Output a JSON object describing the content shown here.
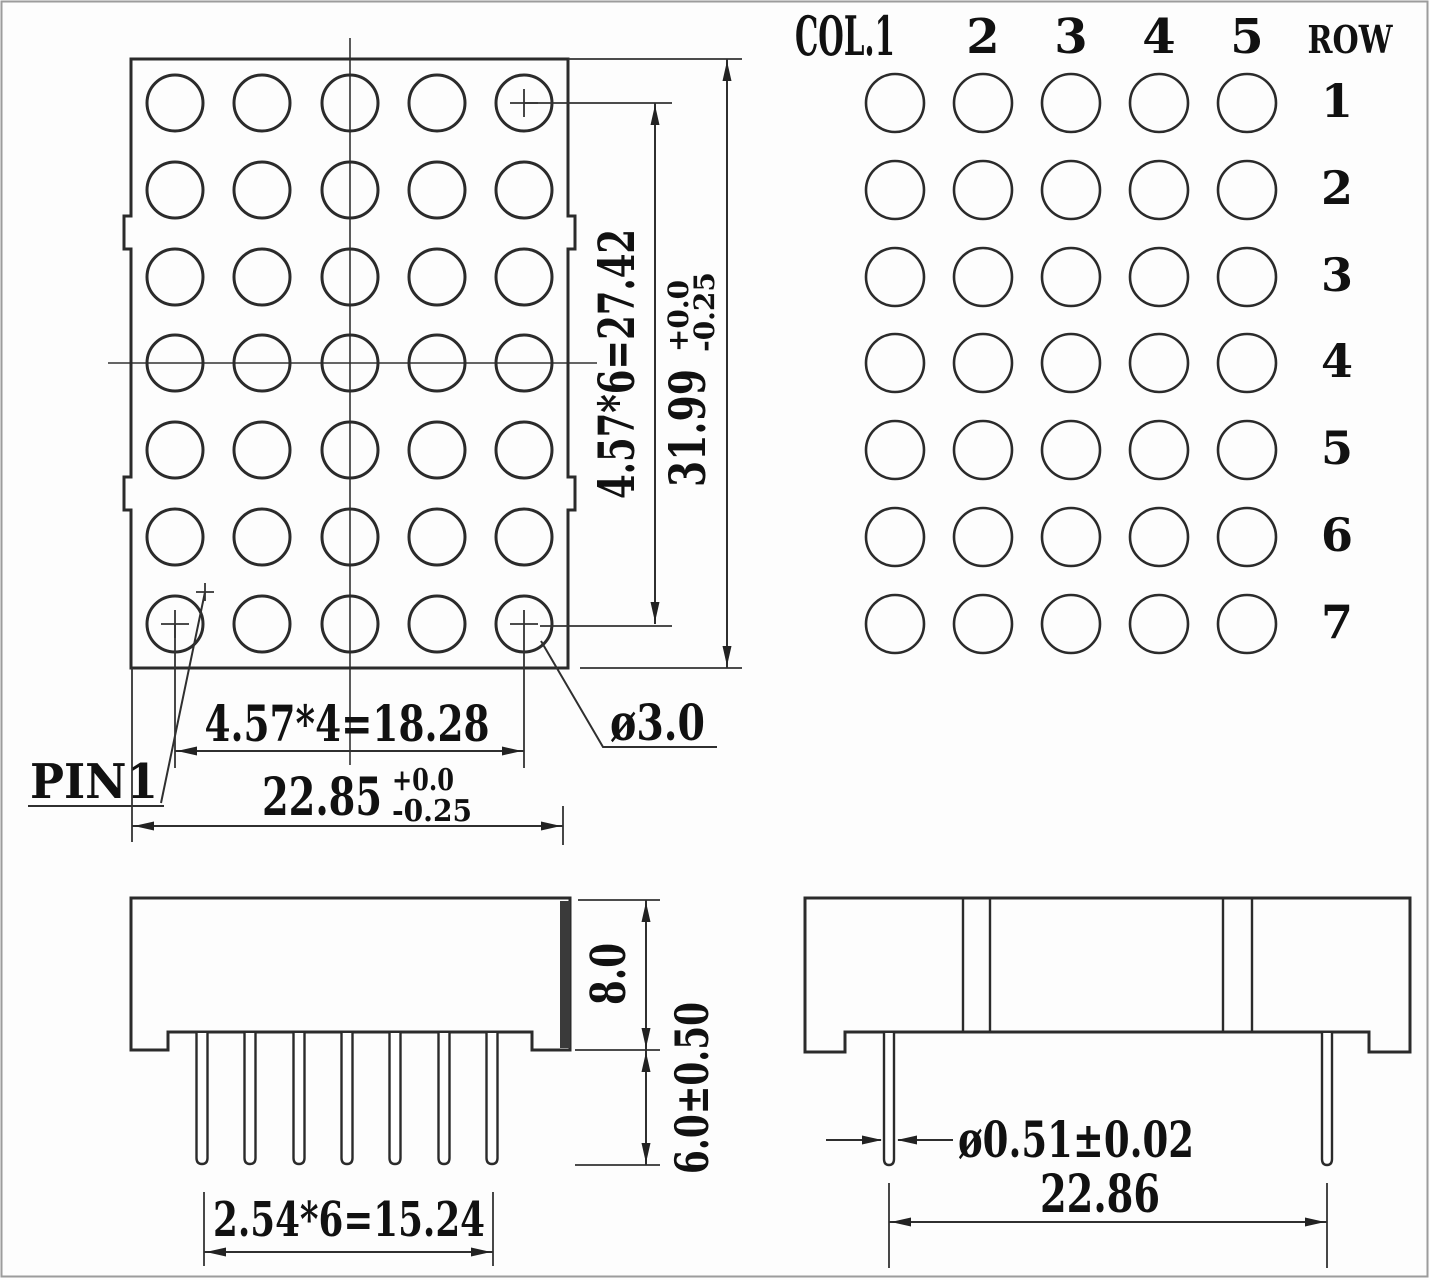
{
  "front_view": {
    "pin1_label": "PIN1",
    "dot_diameter_label": "ø3.0",
    "row_pitch_label": "4.57*6=27.42",
    "height_value": "31.99",
    "height_tol_plus": "+0.0",
    "height_tol_minus": "-0.25",
    "col_pitch_label": "4.57*4=18.28",
    "width_value": "22.85",
    "width_tol_plus": "+0.0",
    "width_tol_minus": "-0.25",
    "grid": {
      "cols": 5,
      "rows": 7
    }
  },
  "pin_map": {
    "col_header": "COL.1",
    "col_labels": [
      "2",
      "3",
      "4",
      "5"
    ],
    "row_header": "ROW",
    "row_labels": [
      "1",
      "2",
      "3",
      "4",
      "5",
      "6",
      "7"
    ],
    "grid": {
      "cols": 5,
      "rows": 7
    }
  },
  "side_view": {
    "body_height_label": "8.0",
    "pin_length_label": "6.0±0.50",
    "pin_pitch_label": "2.54*6=15.24",
    "pin_count": 7
  },
  "end_view": {
    "pin_diameter_label": "ø0.51±0.02",
    "pin_span_label": "22.86",
    "pin_count": 2
  }
}
